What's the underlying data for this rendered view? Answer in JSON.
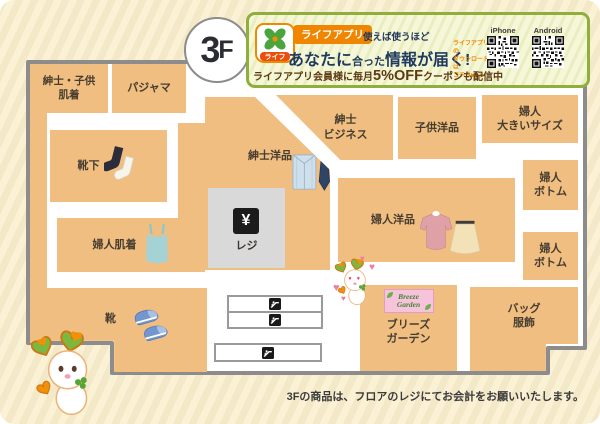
{
  "floor": {
    "number": "3",
    "suffix": "F"
  },
  "banner": {
    "app_icon_label": "ライフ",
    "app_badge": "ライフアプリ",
    "tagline": "使えば使うほど",
    "headline_pre": "あなたに",
    "headline_mid": "合った",
    "headline_post": "情報が届く!",
    "download_note_line1": "ライフアプリの",
    "download_note_line2": "ダウンロードは",
    "download_note_line3": "コチラ▶▶▶",
    "qr_iphone_label": "iPhone",
    "qr_android_label": "Android",
    "coupon_pre": "ライフアプリ会員様に毎月",
    "coupon_highlight": "5%OFF",
    "coupon_post": "クーポンも配信中"
  },
  "map": {
    "register": {
      "symbol": "¥",
      "label": "レジ"
    },
    "breeze_sign": {
      "line1": "Breeze",
      "line2": "Garden"
    },
    "sections": {
      "mens_kids_underwear": {
        "line1": "紳士・子供",
        "line2": "肌着"
      },
      "pajama": {
        "line1": "パジャマ"
      },
      "socks": {
        "line1": "靴下"
      },
      "mens_clothing": {
        "line1": "紳士洋品"
      },
      "mens_business": {
        "line1": "紳士",
        "line2": "ビジネス"
      },
      "kids_clothing": {
        "line1": "子供洋品"
      },
      "womens_large": {
        "line1": "婦人",
        "line2": "大きいサイズ"
      },
      "womens_bottom_upper": {
        "line1": "婦人",
        "line2": "ボトム"
      },
      "womens_underwear": {
        "line1": "婦人肌着"
      },
      "womens_clothing": {
        "line1": "婦人洋品"
      },
      "womens_bottom_lower": {
        "line1": "婦人",
        "line2": "ボトム"
      },
      "shoes": {
        "line1": "靴"
      },
      "breeze_garden": {
        "line1": "ブリーズ",
        "line2": "ガーデン"
      },
      "bags": {
        "line1": "バッグ",
        "line2": "服飾"
      }
    }
  },
  "footer": {
    "note": "3Fの商品は、フロアのレジにてお会計をお願いいたします。"
  },
  "icons": {
    "heart": "♥"
  },
  "colors": {
    "section_fill": "#f0be80",
    "map_outline": "#8c8c8c",
    "banner_border": "#8fae3c",
    "accent_orange": "#f08600",
    "headline_navy": "#1f3a5e",
    "coupon_brown": "#5d3a14",
    "page_bg": "#fbf2d6",
    "register_gray": "#d9d9d9"
  }
}
